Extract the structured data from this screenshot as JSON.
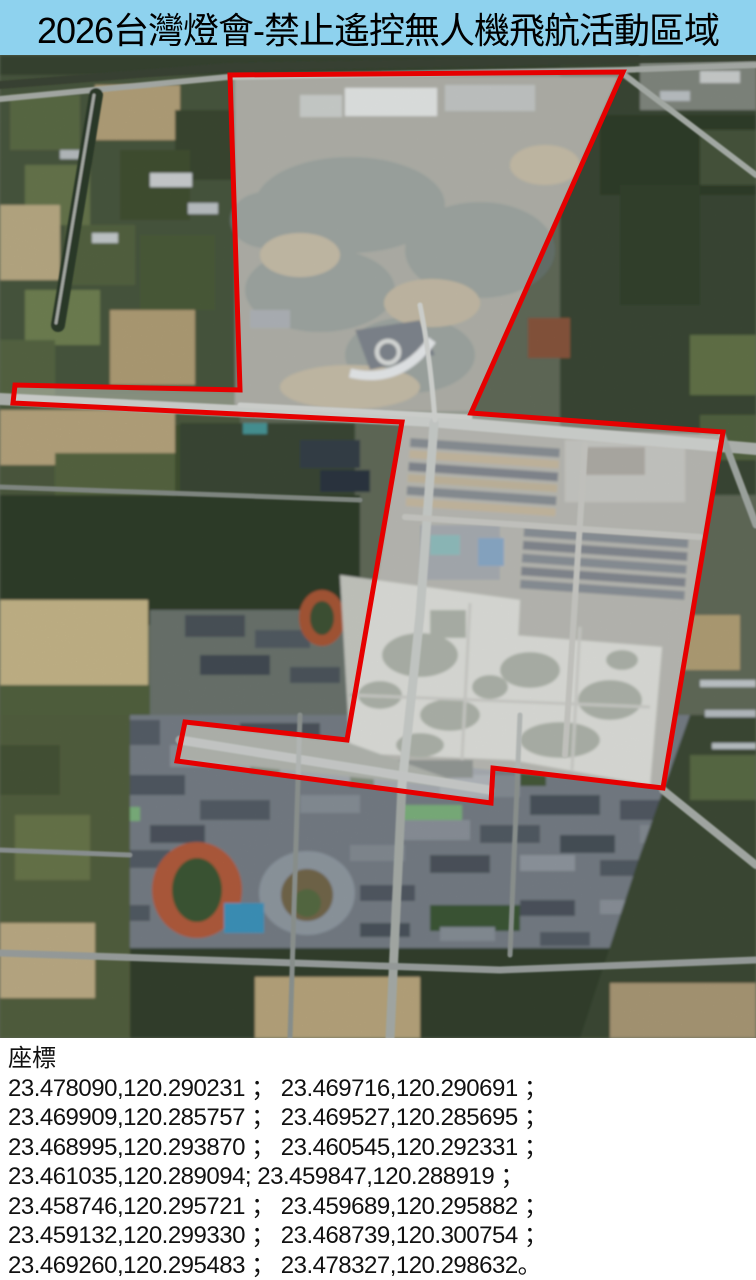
{
  "title": "2026台灣燈會-禁止遙控無人機飛航活動區域",
  "map": {
    "zone_border_color": "#e60000",
    "zone_fill": "rgba(255,255,255,0.34)",
    "polygon_points": "230,20 240,335 15,330 13,348 402,367 347,685 185,667 177,706 491,748 493,713 663,733 723,377 471,358 623,17"
  },
  "coordinates": {
    "label": "座標",
    "lines": [
      "23.478090,120.290231 ； 23.469716,120.290691 ；",
      "23.469909,120.285757 ； 23.469527,120.285695 ；",
      "23.468995,120.293870 ； 23.460545,120.292331 ；",
      "23.461035,120.289094;  23.459847,120.288919 ；",
      "23.458746,120.295721 ； 23.459689,120.295882 ；",
      "23.459132,120.299330 ； 23.468739,120.300754 ；",
      "23.469260,120.295483 ； 23.478327,120.298632。"
    ]
  },
  "colors": {
    "title_bar_bg": "#8ed2ee",
    "title_text": "#000000",
    "panel_bg": "#ffffff",
    "panel_text": "#111111"
  }
}
